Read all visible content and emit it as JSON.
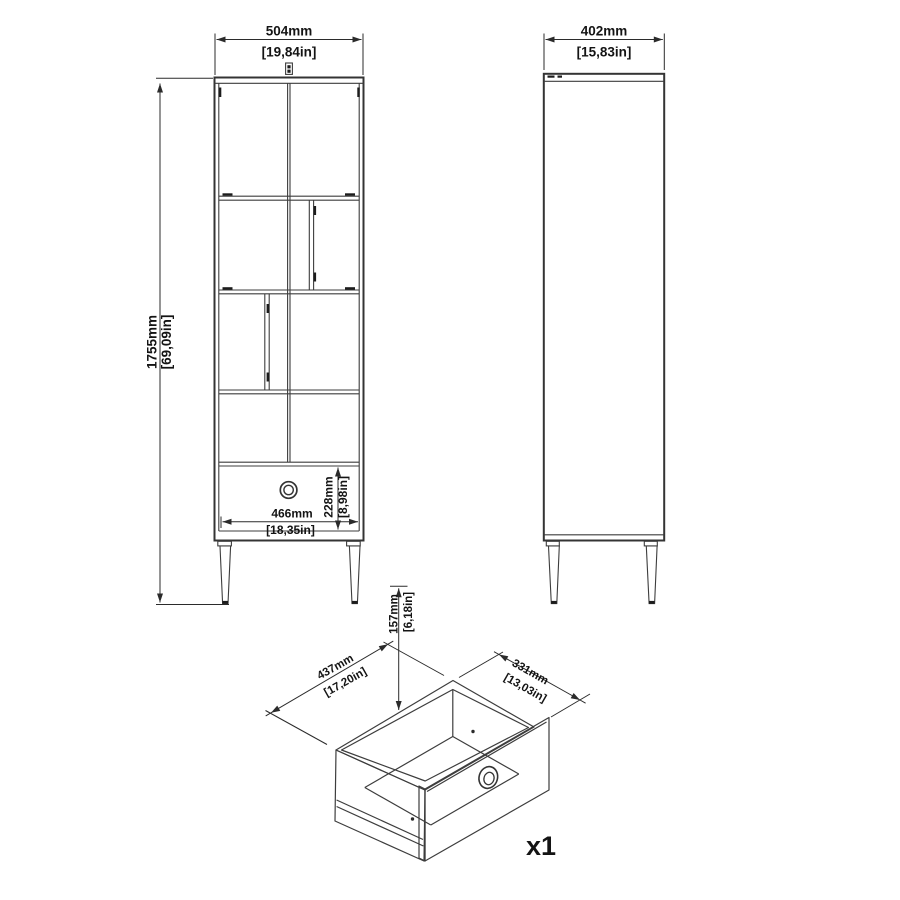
{
  "front_view": {
    "width_mm": "504mm",
    "width_in": "[19,84in]",
    "height_mm": "1755mm",
    "height_in": "[69,09in]",
    "drawer_width_mm": "466mm",
    "drawer_width_in": "[18,35in]",
    "drawer_height_mm": "228mm",
    "drawer_height_in": "[8,98in]"
  },
  "side_view": {
    "depth_mm": "402mm",
    "depth_in": "[15,83in]"
  },
  "drawer_view": {
    "height_mm": "157mm",
    "height_in": "[6,18in]",
    "width_mm": "437mm",
    "width_in": "[17,20in]",
    "depth_mm": "331mm",
    "depth_in": "[13,03in]",
    "quantity_label": "x1"
  },
  "colors": {
    "line": "#3d3d3d",
    "dimension_line": "#2b2b2b",
    "text": "#141414",
    "background": "#ffffff"
  }
}
